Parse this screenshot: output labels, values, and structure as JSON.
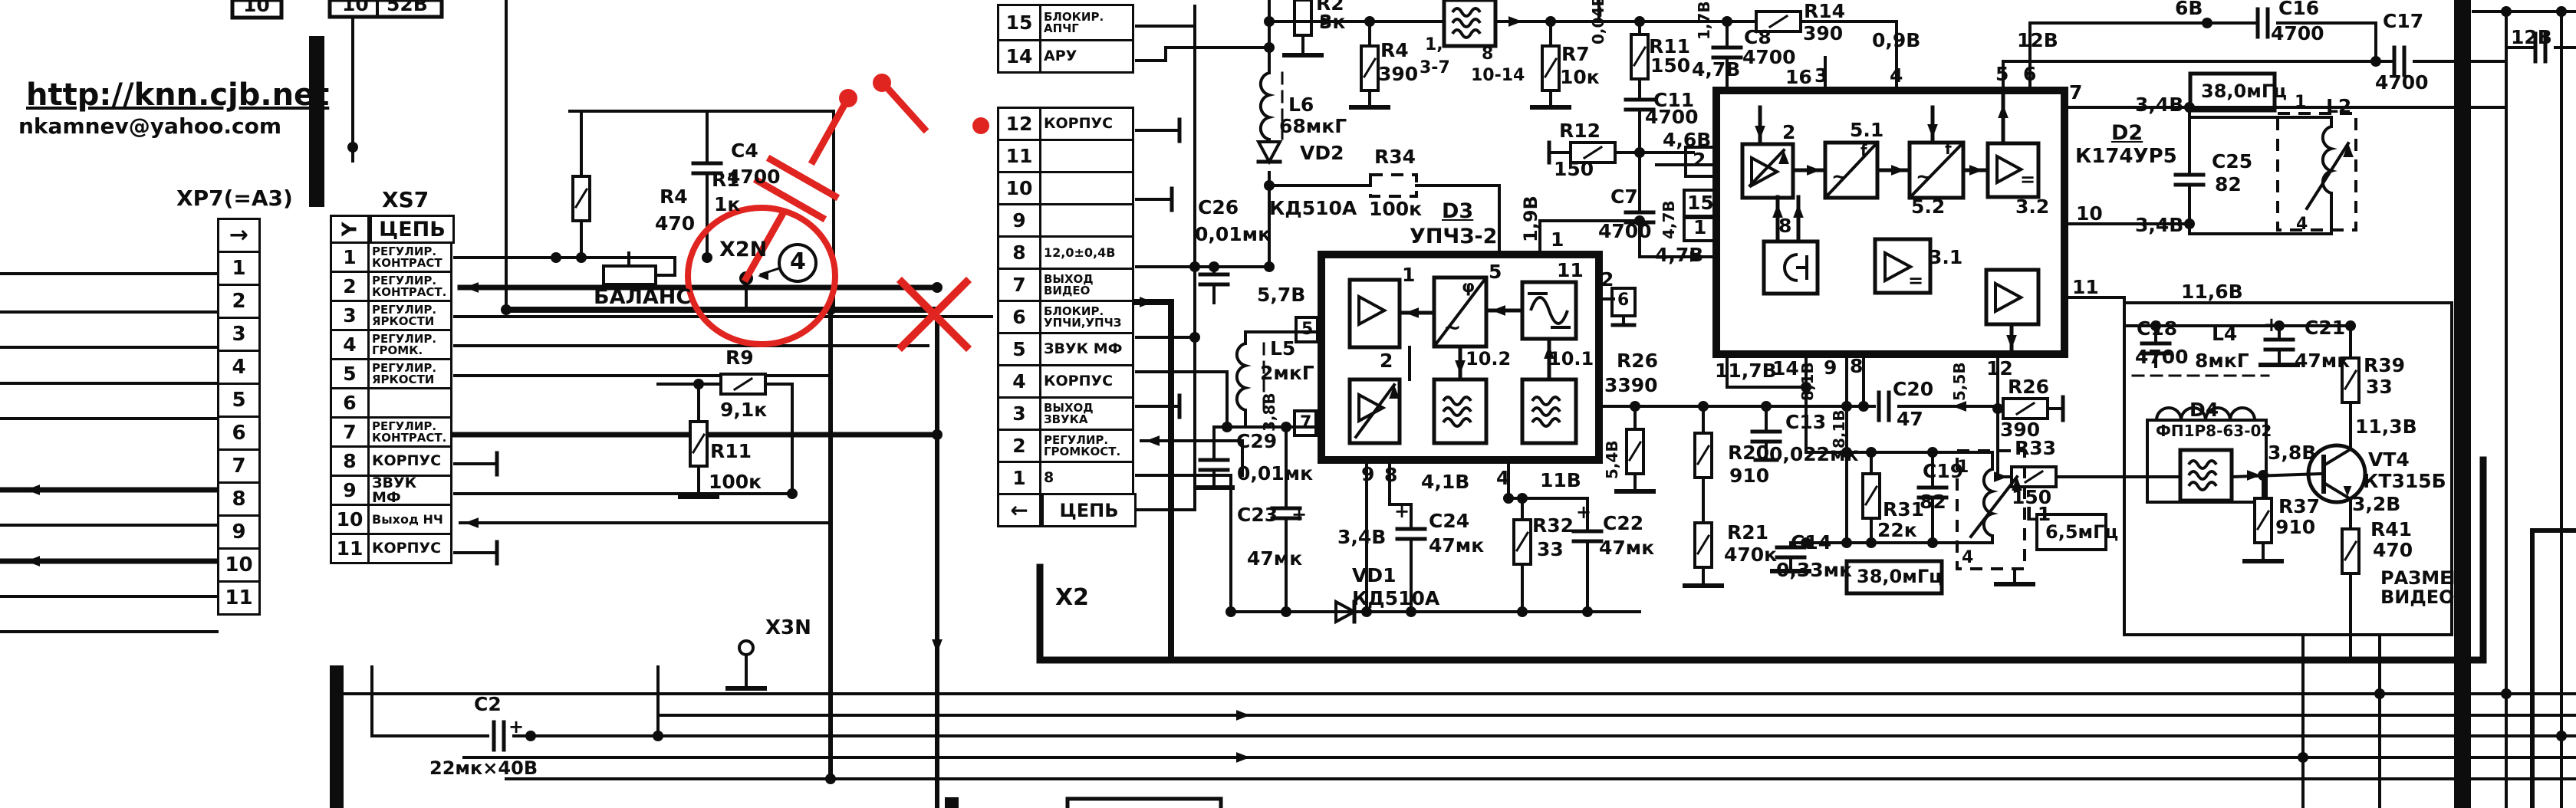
{
  "meta": {
    "url": "http://knn.cjb.net",
    "email": "nkamnev@yahoo.com"
  },
  "connectors": {
    "xp7": {
      "title": "XP7(=A3)",
      "header_arrow": "→",
      "pins": [
        "1",
        "2",
        "3",
        "4",
        "5",
        "6",
        "7",
        "8",
        "9",
        "10",
        "11"
      ]
    },
    "xs7": {
      "title": "XS7",
      "header_symbol": "Y",
      "header_label": "ЦЕПЬ",
      "rows": [
        {
          "pin": "1",
          "label": "РЕГУЛИР.\nКОНТРАСТ"
        },
        {
          "pin": "2",
          "label": "РЕГУЛИР.\nКОНТРАСТ."
        },
        {
          "pin": "3",
          "label": "РЕГУЛИР.\nЯРКОСТИ"
        },
        {
          "pin": "4",
          "label": "РЕГУЛИР.\nГРОМК."
        },
        {
          "pin": "5",
          "label": "РЕГУЛИР.\nЯРКОСТИ"
        },
        {
          "pin": "6",
          "label": ""
        },
        {
          "pin": "7",
          "label": "РЕГУЛИР.\nКОНТРАСТ."
        },
        {
          "pin": "8",
          "label": "КОРПУС"
        },
        {
          "pin": "9",
          "label": "ЗВУК МФ"
        },
        {
          "pin": "10",
          "label": "Выход НЧ"
        },
        {
          "pin": "11",
          "label": "КОРПУС"
        }
      ]
    },
    "x2": {
      "title": "X2",
      "footer_arrow": "←",
      "footer_label": "ЦЕПЬ",
      "rows": [
        {
          "pin": "15",
          "label": "БЛОКИР.\nАПЧГ"
        },
        {
          "pin": "14",
          "label": "АРУ"
        },
        {
          "pin": "12",
          "label": "КОРПУС"
        },
        {
          "pin": "11",
          "label": ""
        },
        {
          "pin": "10",
          "label": ""
        },
        {
          "pin": "9",
          "label": ""
        },
        {
          "pin": "8",
          "label": "12,0±0,4В"
        },
        {
          "pin": "7",
          "label": "ВЫХОД\nВИДЕО"
        },
        {
          "pin": "6",
          "label": "БЛОКИР.\nУПЧИ,УПЧЗ"
        },
        {
          "pin": "5",
          "label": "ЗВУК МФ"
        },
        {
          "pin": "4",
          "label": "КОРПУС"
        },
        {
          "pin": "3",
          "label": "ВЫХОД\nЗВУКА"
        },
        {
          "pin": "2",
          "label": "РЕГУЛИР.\nГРОМКОСТ."
        },
        {
          "pin": "1",
          "label": "8"
        }
      ]
    },
    "fragments": {
      "box1_pin": "10",
      "box2_pin": "10",
      "box2_value": "52В"
    }
  },
  "components": {
    "r1": {
      "ref": "R1",
      "value": "1к"
    },
    "r4a": {
      "ref": "R4",
      "value": "470"
    },
    "c4": {
      "ref": "C4",
      "value": "4700"
    },
    "r9": {
      "ref": "R9",
      "value": "9,1к"
    },
    "r11a": {
      "ref": "R11",
      "value": "100к"
    },
    "c2": {
      "ref": "C2",
      "value": "22мк×40В"
    },
    "r2": {
      "ref": "R2",
      "value": "3к"
    },
    "r4b": {
      "ref": "R4",
      "value": "390"
    },
    "r7": {
      "ref": "R7",
      "value": "10к"
    },
    "r12": {
      "ref": "R12",
      "value": "150"
    },
    "r34": {
      "ref": "R34",
      "value": "100к"
    },
    "l6": {
      "ref": "L6",
      "value": "68мкГ"
    },
    "vd2": {
      "ref": "VD2",
      "value": "КД510А"
    },
    "c26": {
      "ref": "C26",
      "value": "0,01мк"
    },
    "l5": {
      "ref": "L5",
      "value": "2мкГ"
    },
    "c29": {
      "ref": "C29",
      "value": "0,01мк"
    },
    "c23": {
      "ref": "C23",
      "value": "47мк"
    },
    "vd1": {
      "ref": "VD1",
      "value": "КД510А"
    },
    "c24": {
      "ref": "C24",
      "value": "47мк"
    },
    "r32": {
      "ref": "R32",
      "value": "33"
    },
    "c22": {
      "ref": "C22",
      "value": "47мк"
    },
    "r20": {
      "ref": "R20",
      "value": "910"
    },
    "r21": {
      "ref": "R21",
      "value": "470к"
    },
    "c13": {
      "ref": "C13",
      "value": "0,022мк"
    },
    "c14": {
      "ref": "C14",
      "value": "0,33мк"
    },
    "r31": {
      "ref": "R31",
      "value": "22к"
    },
    "c19": {
      "ref": "C19",
      "value": "82"
    },
    "c20": {
      "ref": "C20",
      "value": "47"
    },
    "l1": {
      "ref": "L1",
      "value": ""
    },
    "r26a": {
      "ref": "R26",
      "value": "3390"
    },
    "r26b": {
      "ref": "R26",
      "value": "390"
    },
    "r33": {
      "ref": "R33",
      "value": "150"
    },
    "c7": {
      "ref": "C7",
      "value": "4700"
    },
    "r11b": {
      "ref": "R11",
      "value": "150"
    },
    "c11": {
      "ref": "C11",
      "value": "4700"
    },
    "r14": {
      "ref": "R14",
      "value": "390"
    },
    "c8": {
      "ref": "C8",
      "value": "4700"
    },
    "c16": {
      "ref": "C16",
      "value": "4700"
    },
    "c17": {
      "ref": "C17",
      "value": "4700"
    },
    "c25": {
      "ref": "C25",
      "value": "82"
    },
    "l2": {
      "ref": "L2",
      "value": ""
    },
    "c18": {
      "ref": "C18",
      "value": "4700"
    },
    "l4": {
      "ref": "L4",
      "value": "8мкГ"
    },
    "c21": {
      "ref": "C21",
      "value": "47мк"
    },
    "r39": {
      "ref": "R39",
      "value": "33"
    },
    "d4": {
      "ref": "D4",
      "value": "ФП1Р8-63-02"
    },
    "vt4": {
      "ref": "VT4",
      "value": "КТ315Б"
    },
    "r37": {
      "ref": "R37",
      "value": "910"
    },
    "r41": {
      "ref": "R41",
      "value": "470"
    },
    "d3": {
      "ref": "D3",
      "value": "УПЧЗ-2"
    },
    "d2": {
      "ref": "D2",
      "value": "К174УР5"
    }
  },
  "ics": {
    "d3": {
      "blocks": {
        "b1": "1",
        "b2": "2",
        "b5": "5",
        "b101": "10.1",
        "b102": "10.2",
        "b11": "11"
      },
      "pins": {
        "p1": "1",
        "p2": "2",
        "p4": "4",
        "p5": "5",
        "p7": "7",
        "p8": "8",
        "p9": "9",
        "tag6": "6"
      }
    },
    "d2": {
      "blocks": {
        "b2": "2",
        "b51": "5.1",
        "b52": "5.2",
        "b32": "3.2",
        "b8": "8",
        "b31": "3.1"
      },
      "pins": {
        "t16": "16",
        "t3": "3",
        "t4": "4",
        "t5": "5",
        "t6": "6",
        "l2": "2",
        "l15": "15",
        "l1": "1",
        "r7": "7",
        "r10": "10",
        "r11": "11",
        "b14": "14",
        "b9": "9",
        "b8": "8",
        "b12": "12"
      }
    },
    "fss": {
      "pins_left_a": "1,",
      "pins_left_b": "3-7",
      "pins_right_a": "8",
      "pins_right_b": "10-14"
    },
    "l1_pins": {
      "p1": "1",
      "p4": "4"
    },
    "l2_pins": {
      "p1": "1",
      "p4": "4"
    }
  },
  "voltages": {
    "v004": "0,04В",
    "v09": "0,9В",
    "v17": "1,7В",
    "v46": "4,6В",
    "v47a": "4,7В",
    "v47b": "4,7В",
    "v47c": "4,7В",
    "v6": "6В",
    "v12a": "12В",
    "v12b": "12В",
    "v19": "1,9В",
    "v57": "5,7В",
    "v38a": "3,8В",
    "v38b": "3,8В",
    "v41": "4,1В",
    "v11": "11В",
    "v34a": "3,4В",
    "v34b": "3,4В",
    "v34c": "3,4В",
    "v54": "5,4В",
    "v55": "5,5В",
    "v81a": "8,1В",
    "v81b": "8,1В",
    "v117": "11,7В",
    "v116": "11,6В",
    "v113": "11,3В",
    "v32": "3,2В"
  },
  "frequencies": {
    "f38_top": "38,0мГц",
    "f38_bottom": "38,0мГц",
    "f65": "6,5мГц"
  },
  "annotations": {
    "balance": "БАЛАНС",
    "x2n": "X2N",
    "x3n": "X3N",
    "callout": "4",
    "razmer": "РАЗМЕР\nВИДЕО"
  },
  "glyphs": {
    "plus": "+",
    "phi": "φ",
    "tilde": "~",
    "f": "f",
    "eq": "="
  },
  "colors": {
    "ink": "#0d0d0d",
    "annotation_red": "#e02420",
    "paper": "#ffffff"
  }
}
